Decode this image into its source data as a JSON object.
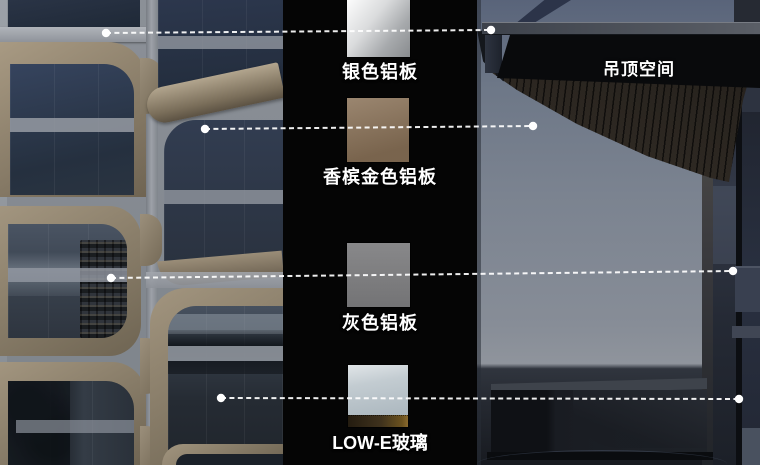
{
  "legend": {
    "strip_bg": "#050505",
    "materials": [
      {
        "id": "silver-aluminum-panel",
        "name": "银色铝板",
        "color": "#c7c9cb"
      },
      {
        "id": "champagne-gold-aluminum-panel",
        "name": "香槟金色铝板",
        "color": "#8a7258"
      },
      {
        "id": "gray-aluminum-panel",
        "name": "灰色铝板",
        "color": "#7f7f81"
      },
      {
        "id": "low-e-glass",
        "name": "LOW-E玻璃",
        "color": "#bcc6cc"
      }
    ]
  },
  "section": {
    "ceiling_label": "吊顶空间"
  },
  "callout": {
    "color": "#ffffff"
  }
}
